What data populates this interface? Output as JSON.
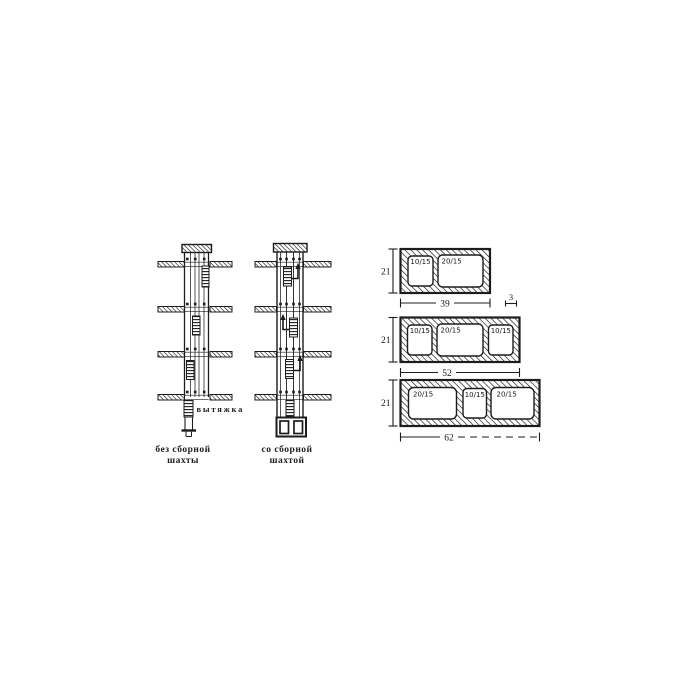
{
  "figure": {
    "background": "#ffffff",
    "ink": "#1c1c1c",
    "shafts": {
      "exhaust_label": "вытяжка",
      "caption_without_line1": "без сборной",
      "caption_without_line2": "шахты",
      "caption_with_line1": "со сборной",
      "caption_with_line2": "шахтой"
    },
    "blocks": [
      {
        "openings": [
          "10/15",
          "20/15"
        ],
        "height": "21",
        "width": "39",
        "wall": "3"
      },
      {
        "openings": [
          "10/15",
          "20/15",
          "10/15"
        ],
        "height": "21",
        "width": "52"
      },
      {
        "openings": [
          "20/15",
          "10/15",
          "20/15"
        ],
        "height": "21",
        "width": "62"
      }
    ]
  }
}
